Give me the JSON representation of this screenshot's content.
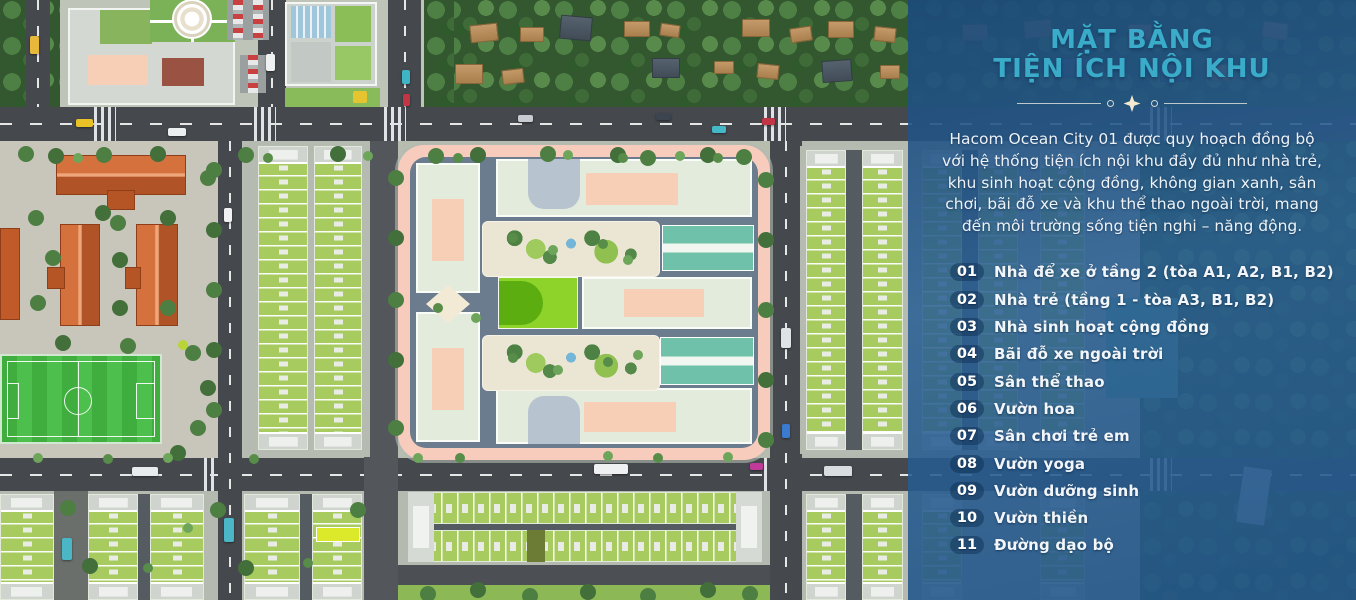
{
  "panel": {
    "title_line1": "MẶT BẰNG",
    "title_line2": "TIỆN ÍCH NỘI KHU",
    "intro": "Hacom Ocean City 01 được quy hoạch đồng bộ với hệ thống tiện ích nội khu đầy đủ như nhà trẻ, khu sinh hoạt cộng đồng, không gian xanh, sân chơi, bãi đỗ xe và khu thể thao ngoài trời, mang đến môi trường sống tiện nghi – năng động.",
    "items": [
      {
        "num": "01",
        "label": "Nhà để xe ở tầng 2 (tòa A1, A2, B1, B2)"
      },
      {
        "num": "02",
        "label": "Nhà trẻ (tầng 1 - tòa A3, B1, B2)"
      },
      {
        "num": "03",
        "label": "Nhà sinh hoạt cộng đồng"
      },
      {
        "num": "04",
        "label": "Bãi đỗ xe ngoài trời"
      },
      {
        "num": "05",
        "label": "Sân thể thao"
      },
      {
        "num": "06",
        "label": "Vườn hoa"
      },
      {
        "num": "07",
        "label": "Sân chơi trẻ em"
      },
      {
        "num": "08",
        "label": "Vườn yoga"
      },
      {
        "num": "09",
        "label": "Vườn dưỡng sinh"
      },
      {
        "num": "10",
        "label": "Vườn thiền"
      },
      {
        "num": "11",
        "label": "Đường dạo bộ"
      }
    ],
    "colors": {
      "panel_blue": "#2a5f94",
      "title_teal": "#3aabc9",
      "divider_cream": "#f4e9cf",
      "text_white": "#eef3f8"
    }
  },
  "map": {
    "colors": {
      "highlight_lot": "#dce92b",
      "shophouse_roof": "#a8cb60",
      "complex_sidewalk_pink": "#f8ccbd",
      "sport_court_teal": "#6fc2a9",
      "traditional_roof_red": "#c05a28",
      "soccer_field_green": "#44b544"
    }
  }
}
